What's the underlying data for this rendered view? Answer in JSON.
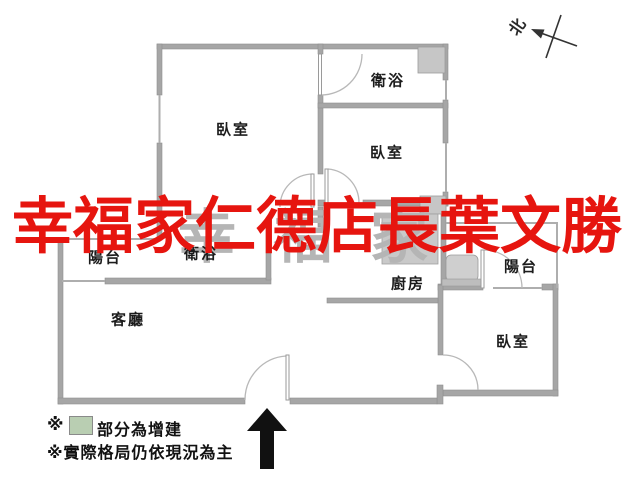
{
  "plan": {
    "title_context": "apartment floor plan",
    "rooms": [
      {
        "id": "bedroom-top-left",
        "label": "臥室",
        "cx": 233,
        "cy": 129
      },
      {
        "id": "bathroom-top",
        "label": "衛浴",
        "cx": 388,
        "cy": 80
      },
      {
        "id": "bedroom-top-right",
        "label": "臥室",
        "cx": 387,
        "cy": 152
      },
      {
        "id": "balcony-left",
        "label": "陽台",
        "cx": 105,
        "cy": 257
      },
      {
        "id": "bathroom-middle",
        "label": "衛浴",
        "cx": 201,
        "cy": 253
      },
      {
        "id": "kitchen",
        "label": "廚房",
        "cx": 408,
        "cy": 283
      },
      {
        "id": "balcony-right",
        "label": "陽台",
        "cx": 521,
        "cy": 266
      },
      {
        "id": "living-room",
        "label": "客廳",
        "cx": 128,
        "cy": 319
      },
      {
        "id": "bedroom-bottom-right",
        "label": "臥室",
        "cx": 513,
        "cy": 341
      }
    ],
    "compass": {
      "label": "北"
    },
    "legend": {
      "marker": "※",
      "added_area_text": "部分為增建",
      "added_area_color": "#b9ceb2",
      "note": "※實際格局仍依現況為主"
    },
    "watermark_front": {
      "text": "幸福家仁德店長葉文勝",
      "color": "#e6150f"
    },
    "watermark_back": {
      "text": "幸福家",
      "color": "#b5b5b5"
    },
    "colors": {
      "wall": "#a6a6a6",
      "window_line": "#aeaeae",
      "fixture_fill": "#cdcdcd",
      "door_arc": "#b8b8b8",
      "entrance_arrow": "#111111"
    }
  }
}
